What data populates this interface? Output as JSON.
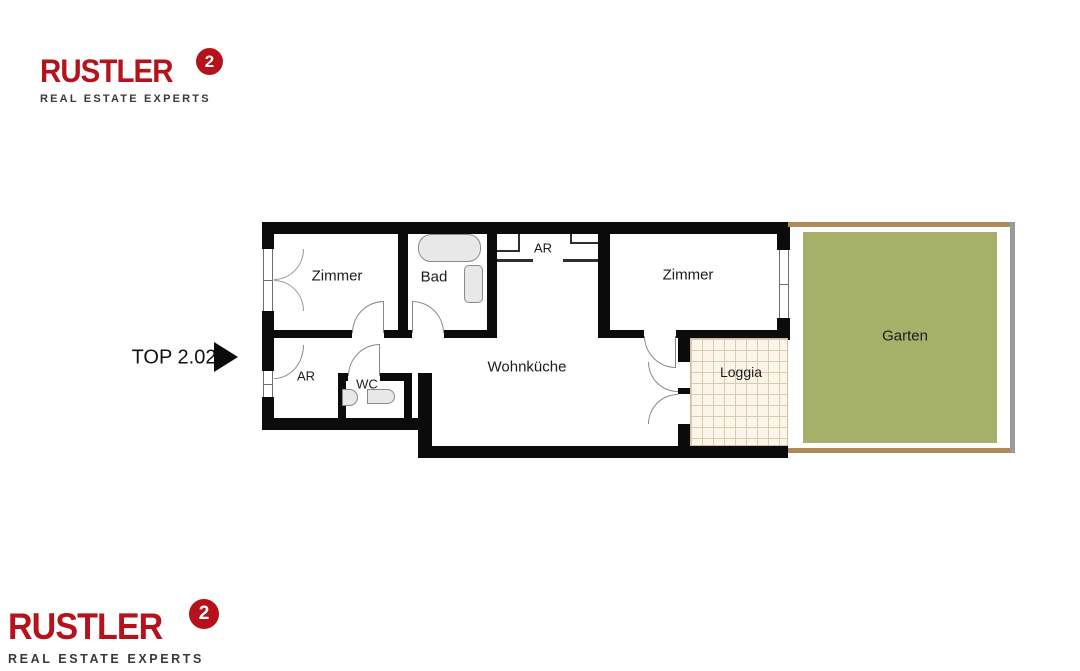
{
  "branding": {
    "logo_text": "RUSTLER",
    "logo_mark": "2",
    "tagline": "REAL ESTATE EXPERTS",
    "brand_red": "#b5121b",
    "tagline_color": "#3a3a3a"
  },
  "unit": {
    "label": "TOP 2.02"
  },
  "plan": {
    "rooms": [
      {
        "id": "zimmer-left",
        "label": "Zimmer"
      },
      {
        "id": "bad",
        "label": "Bad"
      },
      {
        "id": "ar-top",
        "label": "AR"
      },
      {
        "id": "zimmer-right",
        "label": "Zimmer"
      },
      {
        "id": "ar-bottom",
        "label": "AR"
      },
      {
        "id": "wc",
        "label": "WC"
      },
      {
        "id": "wohnkueche",
        "label": "Wohnküche"
      },
      {
        "id": "loggia",
        "label": "Loggia"
      },
      {
        "id": "garten",
        "label": "Garten"
      }
    ]
  },
  "colors": {
    "wall_black": "#0b0b0b",
    "garden_green": "#a5b069",
    "garden_border_tan": "#b08b5a",
    "garden_border_gray": "#9a9a9a",
    "loggia_tile_bg": "#faf5e8",
    "loggia_tile_line": "#d9cbb0",
    "fixture_fill": "#e8e8e8",
    "fixture_line": "#8a8a8a"
  }
}
